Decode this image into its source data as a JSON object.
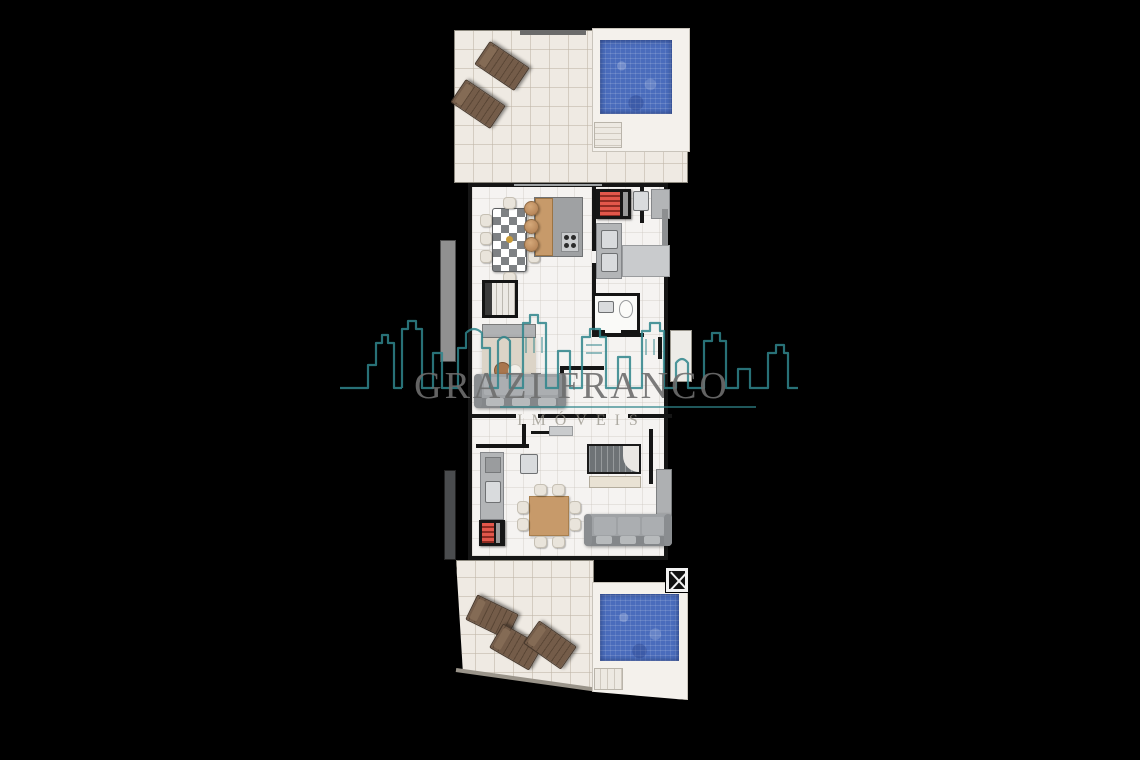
{
  "canvas": {
    "width": 1140,
    "height": 760,
    "background": "#000000"
  },
  "watermark": {
    "title": "GRAZI FRANCO",
    "subtitle": "IMÓVEIS",
    "title_color": "#6E6E6E",
    "accent_color": "#2F858C",
    "skyline_icon": "city-skyline-outline"
  },
  "palette": {
    "wall": "#151515",
    "interior_floor": "#F5F3F1",
    "terrace_tile": "#EFEAE3",
    "tile_grid_line": "#BEB4A5",
    "pool_deck": "#F4F1EC",
    "pool_water": "#4A6CBC",
    "lounger_wood": "#745C49",
    "furniture_wood": "#C79A6A",
    "counter_gray": "#B3B5B7",
    "sofa_gray": "#9FA2A5",
    "grill_red": "#E2574B",
    "rug_beige": "#DCD4C7"
  },
  "floor_plan": {
    "type": "duplex-penthouse-floor-plan-top-view",
    "areas": {
      "upper_terrace": {
        "label": "upper terrace",
        "pool": true,
        "sun_loungers": 2,
        "pool_steps": true
      },
      "main_level": {
        "label": "main level",
        "furniture": [
          "dining-table-8-seats",
          "kitchen-island-with-3-stools",
          "cooktop",
          "built-in-grill",
          "double-sink-counter",
          "fridge",
          "bathroom-toilet",
          "bathroom-sink",
          "staircase",
          "sideboard",
          "rug-with-coffee-table",
          "sofa",
          "wardrobe"
        ]
      },
      "lower_level": {
        "label": "lower level",
        "furniture": [
          "kitchen-counter-with-sink",
          "built-in-grill",
          "square-dining-table-8-seats",
          "sofa",
          "staircase",
          "cabinet",
          "laundry-sink",
          "service-duct"
        ]
      },
      "lower_terrace": {
        "label": "lower terrace",
        "pool": true,
        "sun_loungers": 3,
        "pool_steps": true,
        "elevator_shaft": true
      }
    }
  }
}
